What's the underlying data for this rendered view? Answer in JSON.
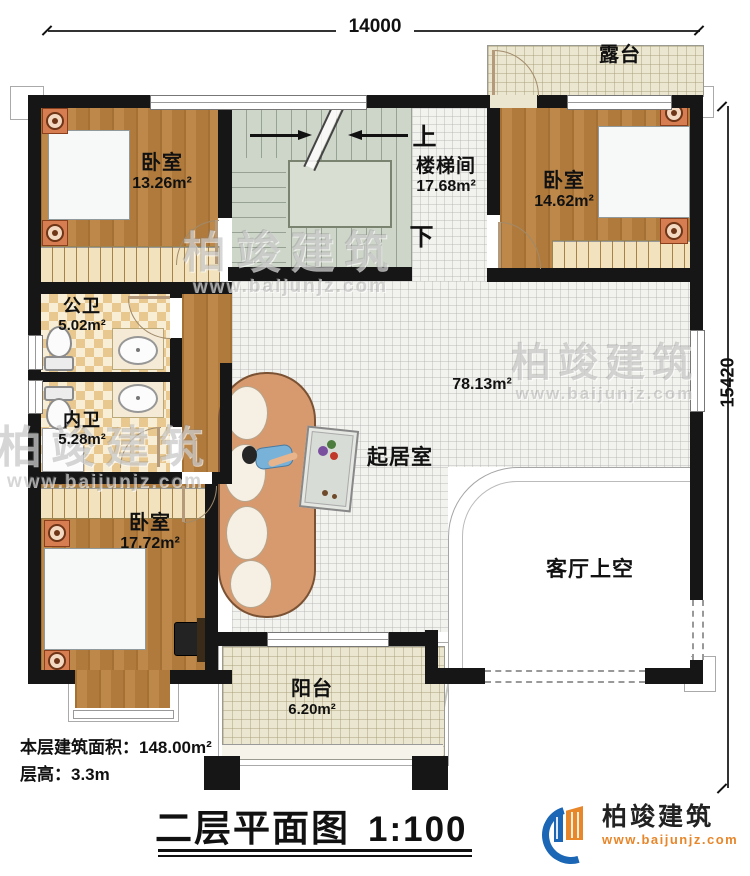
{
  "dimensions": {
    "top": "14000",
    "right": "15420"
  },
  "rooms": {
    "terrace": {
      "name": "露台"
    },
    "bedroom_tl": {
      "name": "卧室",
      "area": "13.26m²"
    },
    "stairwell": {
      "name": "楼梯间",
      "area": "17.68m²",
      "up": "上",
      "down": "下"
    },
    "bedroom_tr": {
      "name": "卧室",
      "area": "14.62m²"
    },
    "bath_public": {
      "name": "公卫",
      "area": "5.02m²"
    },
    "bath_inner": {
      "name": "内卫",
      "area": "5.28m²"
    },
    "bedroom_bl": {
      "name": "卧室",
      "area": "17.72m²"
    },
    "living": {
      "name": "起居室",
      "area": "78.13m²"
    },
    "void": {
      "name": "客厅上空"
    },
    "balcony": {
      "name": "阳台",
      "area": "6.20m²"
    }
  },
  "notes": {
    "line1_label": "本层建筑面积：",
    "line1_value": "148.00m²",
    "line2_label": "层高：",
    "line2_value": "3.3m"
  },
  "title_block": {
    "title": "二层平面图",
    "scale": "1:100"
  },
  "brand": {
    "name": "柏竣建筑",
    "url": "www.baijunjz.com"
  },
  "watermark": {
    "text": "柏竣建筑",
    "url": "www.baijunjz.com"
  },
  "colors": {
    "wall": "#161616",
    "wood": "#b9813f",
    "bath_tile": "#e8c88e",
    "living_tile": "#f2f2ee",
    "terrace_floor": "#ebe6cf",
    "stair": "#ced5c9",
    "bed": "#7ec7da",
    "logo_blue": "#1b66b5",
    "logo_orange": "#e8862a"
  }
}
